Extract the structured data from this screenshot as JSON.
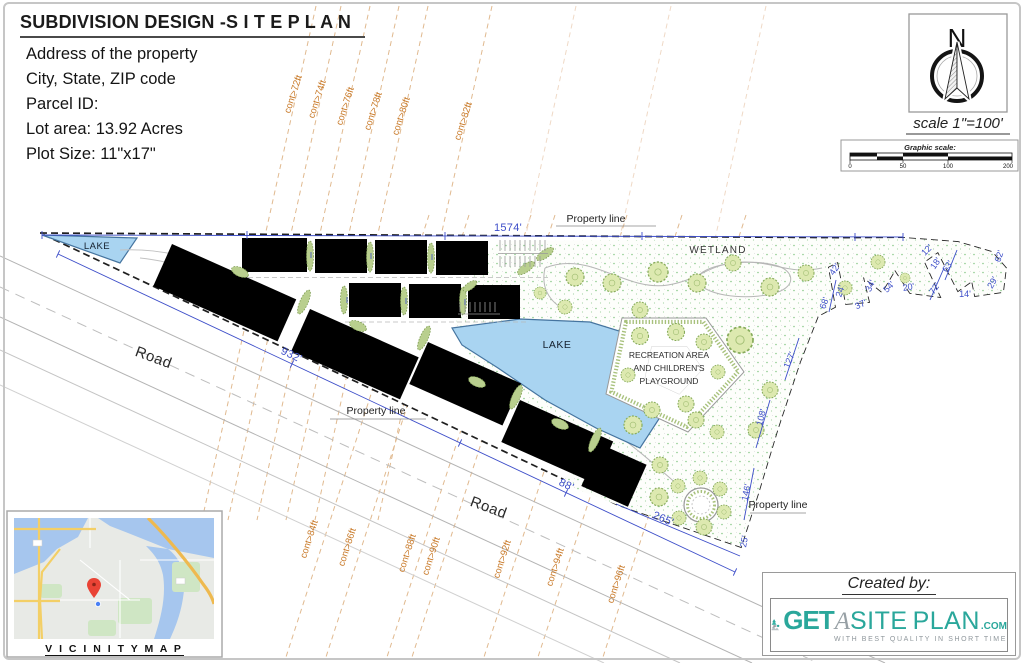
{
  "title_block": {
    "title_main": "SUBDIVISION DESIGN -",
    "title_spaced": "S I T E  P L A N",
    "lines": [
      "Address of the property",
      "City, State, ZIP code",
      "Parcel ID:",
      "Lot area: 13.92 Acres",
      "Plot Size: 11\"x17\""
    ]
  },
  "north_arrow": {
    "letter": "N",
    "scale_label": "scale 1\"=100'"
  },
  "graphic_scale": {
    "label": "Graphic scale:",
    "ticks": [
      "0",
      "50",
      "100",
      "200"
    ]
  },
  "contours": {
    "top": [
      "cont>72ft",
      "cont>74ft",
      "cont>76ft",
      "cont>78ft",
      "cont>80ft",
      "cont>82ft"
    ],
    "bottom": [
      "cont>84ft",
      "cont>86ft",
      "cont>88ft",
      "cont>90ft",
      "cont>92ft",
      "cont>94ft",
      "cont>96ft"
    ]
  },
  "plan": {
    "labels": {
      "property_line": "Property line",
      "road": "Road",
      "lake": "LAKE",
      "wetland": "WETLAND",
      "recreation_line1": "RECREATION AREA",
      "recreation_line2": "AND CHILDREN'S",
      "recreation_line3": "PLAYGROUND"
    },
    "dimensions": {
      "top": "1574'",
      "road_front": "932'",
      "road_front2": "88'",
      "bottom": "265'",
      "east": [
        "42'",
        "24'",
        "68'",
        "34'",
        "37'",
        "54'",
        "20'",
        "72'",
        "12'",
        "18'",
        "63'",
        "14'",
        "29'",
        "62'",
        "127'",
        "108'",
        "146'",
        "25'"
      ]
    }
  },
  "vicinity_map": {
    "caption": "V I C I N I T Y  M A P"
  },
  "created_by": {
    "label": "Created by:",
    "brand_get": "GET",
    "brand_a": "A",
    "brand_site": "SITE",
    "brand_plan": "PLAN",
    "brand_com": ".COM",
    "tagline": "WITH BEST QUALITY IN SHORT TIME"
  },
  "colors": {
    "contour": "#c87826",
    "dimension": "#3d4ec9",
    "lake_fill": "#a9d4f1",
    "brand_teal": "#2aa79b"
  }
}
